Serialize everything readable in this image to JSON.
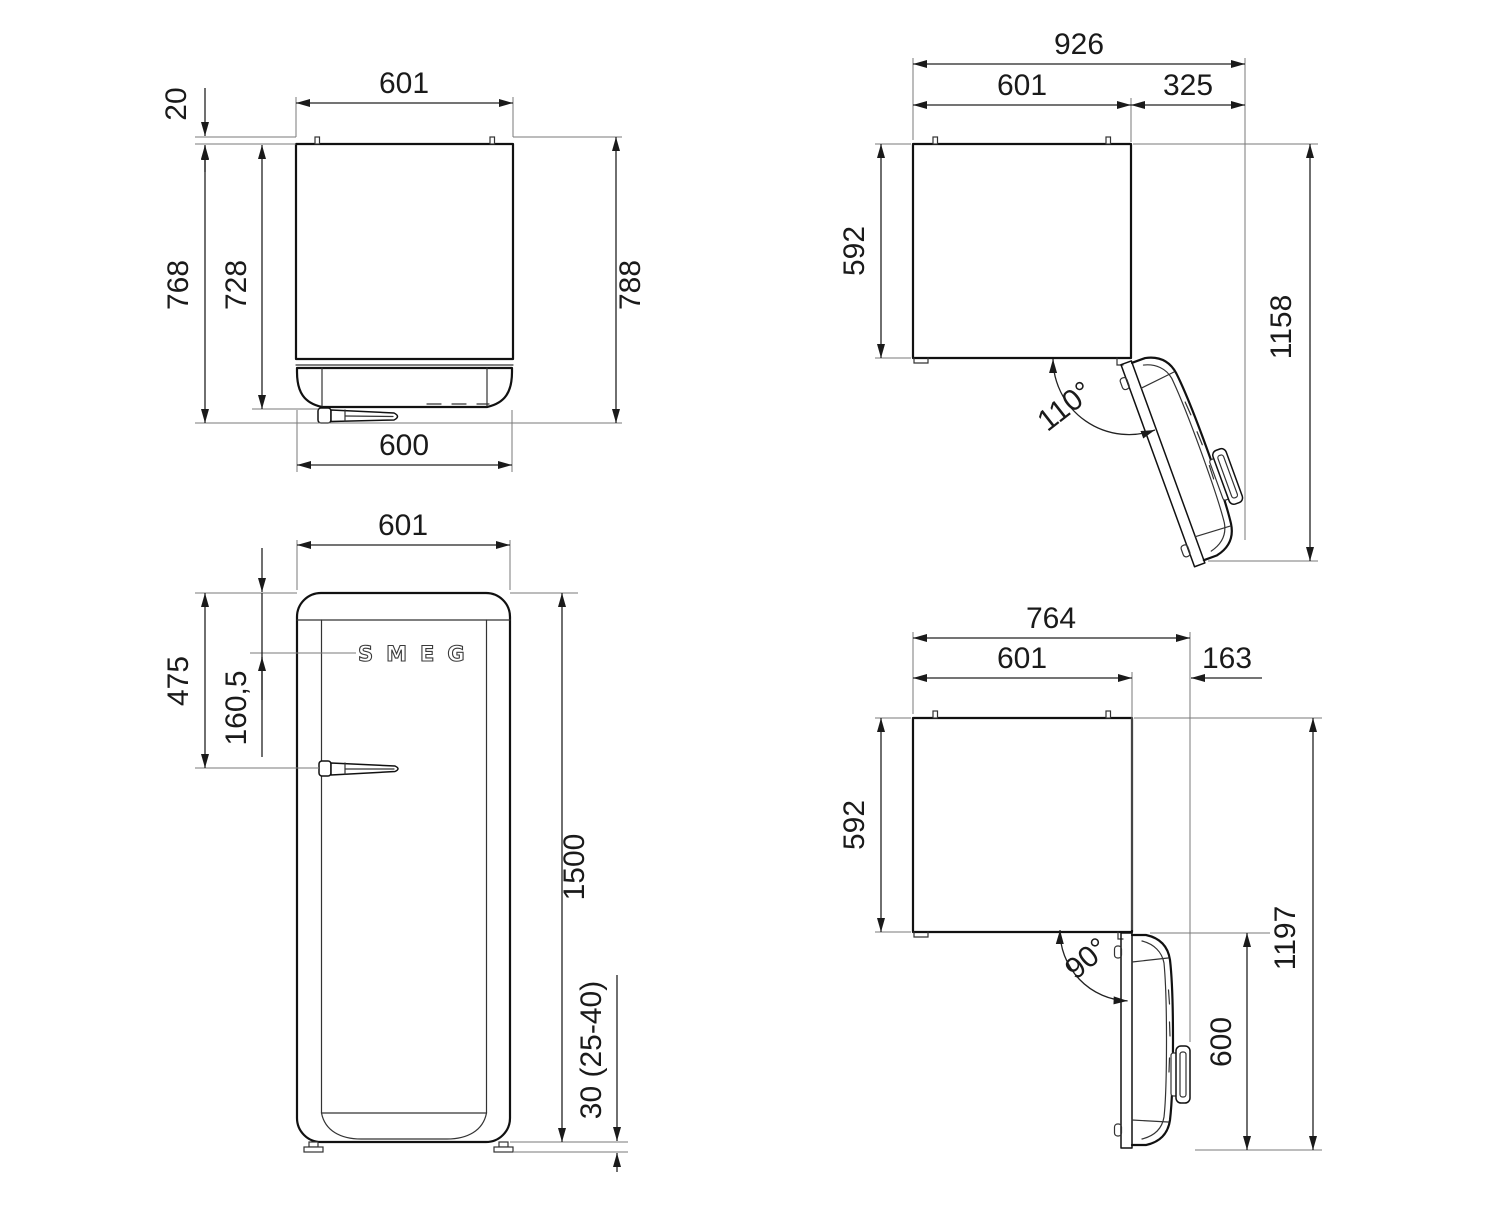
{
  "views": {
    "plan_closed": {
      "title": "top view door closed",
      "dims": {
        "width": "601",
        "wall_spacer": "20",
        "depth_with_handle": "768",
        "depth_body": "728",
        "depth_total": "788",
        "door_width": "600"
      }
    },
    "plan_open_110": {
      "title": "top view door open 110",
      "dims": {
        "total_width": "926",
        "cabinet_width": "601",
        "door_clearance": "325",
        "cabinet_depth": "592",
        "total_depth": "1158",
        "door_angle": "110°"
      }
    },
    "front": {
      "logo": "SMEG",
      "title": "front view",
      "dims": {
        "width": "601",
        "handle_from_top": "475",
        "logo_from_top": "160,5",
        "height": "1500",
        "feet_height": "30 (25-40)"
      }
    },
    "plan_open_90": {
      "title": "top view door open 90",
      "dims": {
        "total_width": "764",
        "cabinet_width": "601",
        "door_clearance": "163",
        "cabinet_depth": "592",
        "total_depth": "1197",
        "door_depth": "600",
        "door_angle": "90°"
      }
    }
  }
}
